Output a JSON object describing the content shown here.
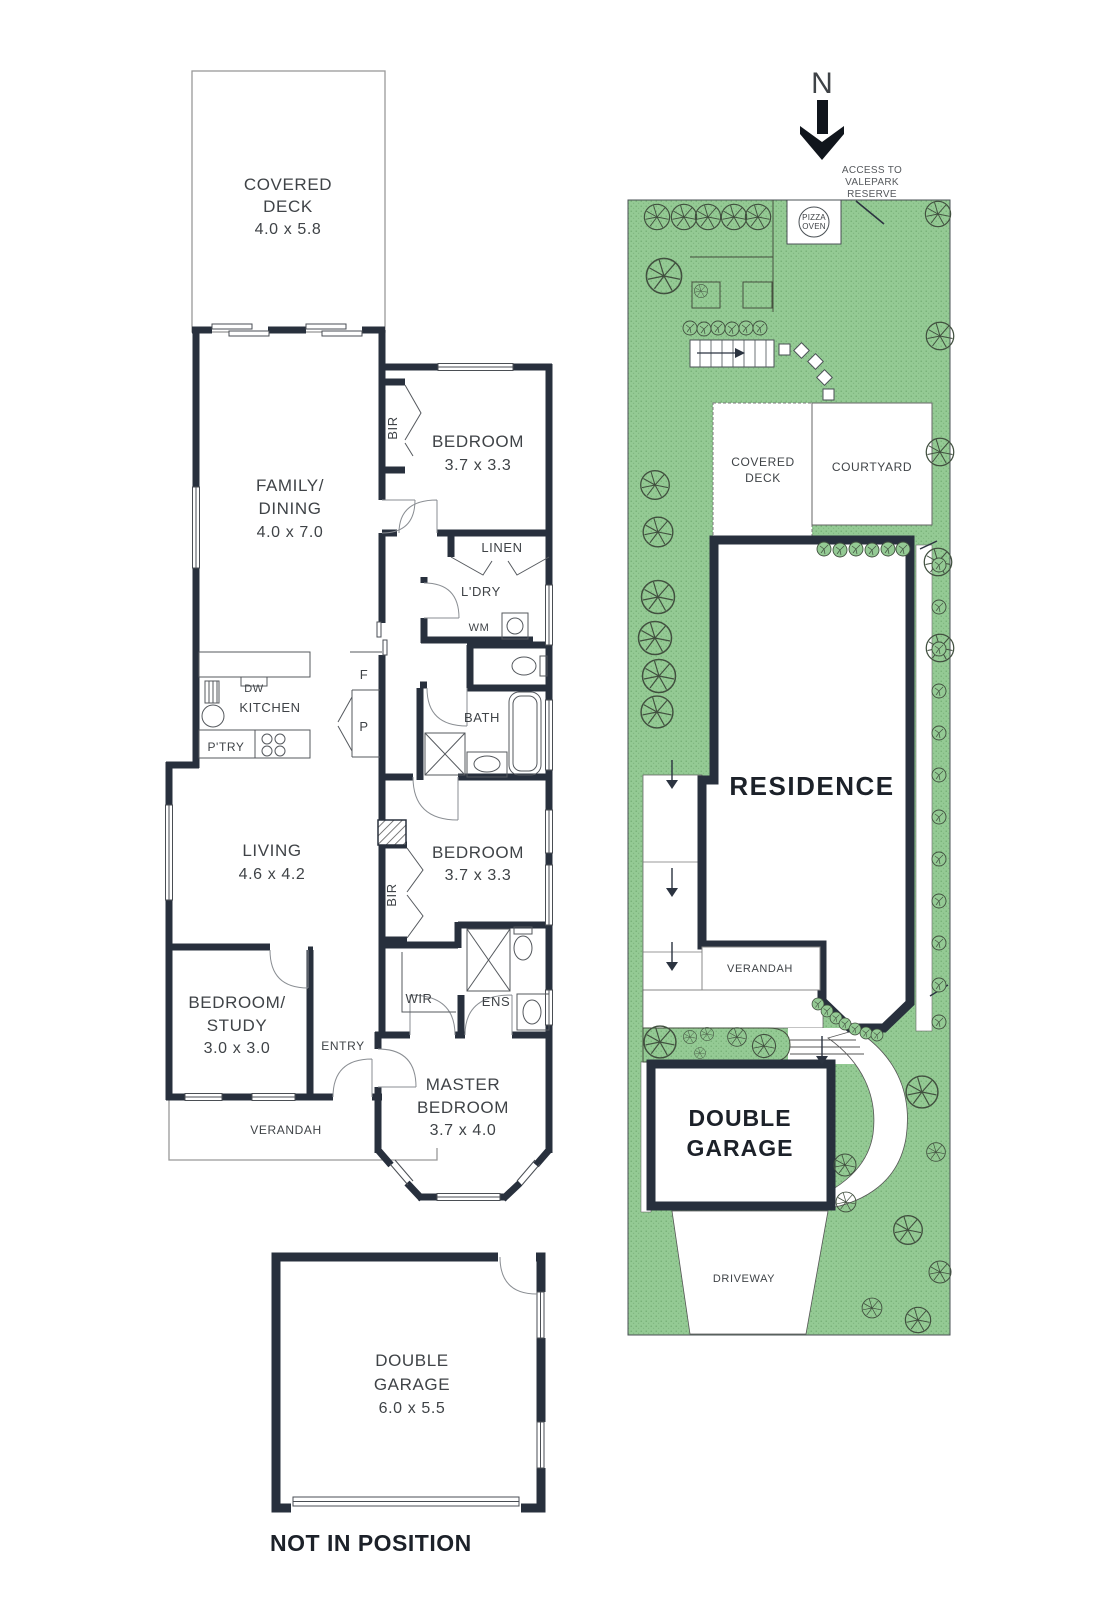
{
  "colors": {
    "wall": "#28303d",
    "garden_green": "#94ca94",
    "garden_dot": "#6fa96f",
    "thin_line": "#55595e",
    "text": "#3f4347",
    "bold_text": "#1c2129"
  },
  "floorplan": {
    "covered_deck": {
      "l1": "COVERED",
      "l2": "DECK",
      "dims": "4.0 x 5.8"
    },
    "bedroom1": {
      "name": "BEDROOM",
      "dims": "3.7 x 3.3"
    },
    "bir1": "BIR",
    "family": {
      "l1": "FAMILY/",
      "l2": "DINING",
      "dims": "4.0 x 7.0"
    },
    "linen": "LINEN",
    "ldry": "L'DRY",
    "wm": "WM",
    "dw": "DW",
    "kitchen": "KITCHEN",
    "ptry": "P'TRY",
    "fridge": "F",
    "pantry": "P",
    "bath": "BATH",
    "living": {
      "name": "LIVING",
      "dims": "4.6 x 4.2"
    },
    "bedroom2": {
      "name": "BEDROOM",
      "dims": "3.7 x 3.3"
    },
    "bir2": "BIR",
    "wir": "WIR",
    "ens": "ENS",
    "study": {
      "l1": "BEDROOM/",
      "l2": "STUDY",
      "dims": "3.0 x 3.0"
    },
    "entry": "ENTRY",
    "verandah": "VERANDAH",
    "master": {
      "l1": "MASTER",
      "l2": "BEDROOM",
      "dims": "3.7 x 4.0"
    },
    "garage": {
      "l1": "DOUBLE",
      "l2": "GARAGE",
      "dims": "6.0 x 5.5"
    },
    "note": "NOT IN POSITION"
  },
  "siteplan": {
    "compass": "N",
    "access": {
      "l1": "ACCESS TO",
      "l2": "VALEPARK",
      "l3": "RESERVE"
    },
    "pizza": {
      "l1": "PIZZA",
      "l2": "OVEN"
    },
    "covered_deck": {
      "l1": "COVERED",
      "l2": "DECK"
    },
    "courtyard": "COURTYARD",
    "residence": "RESIDENCE",
    "verandah": "VERANDAH",
    "garage": {
      "l1": "DOUBLE",
      "l2": "GARAGE"
    },
    "driveway": "DRIVEWAY"
  }
}
